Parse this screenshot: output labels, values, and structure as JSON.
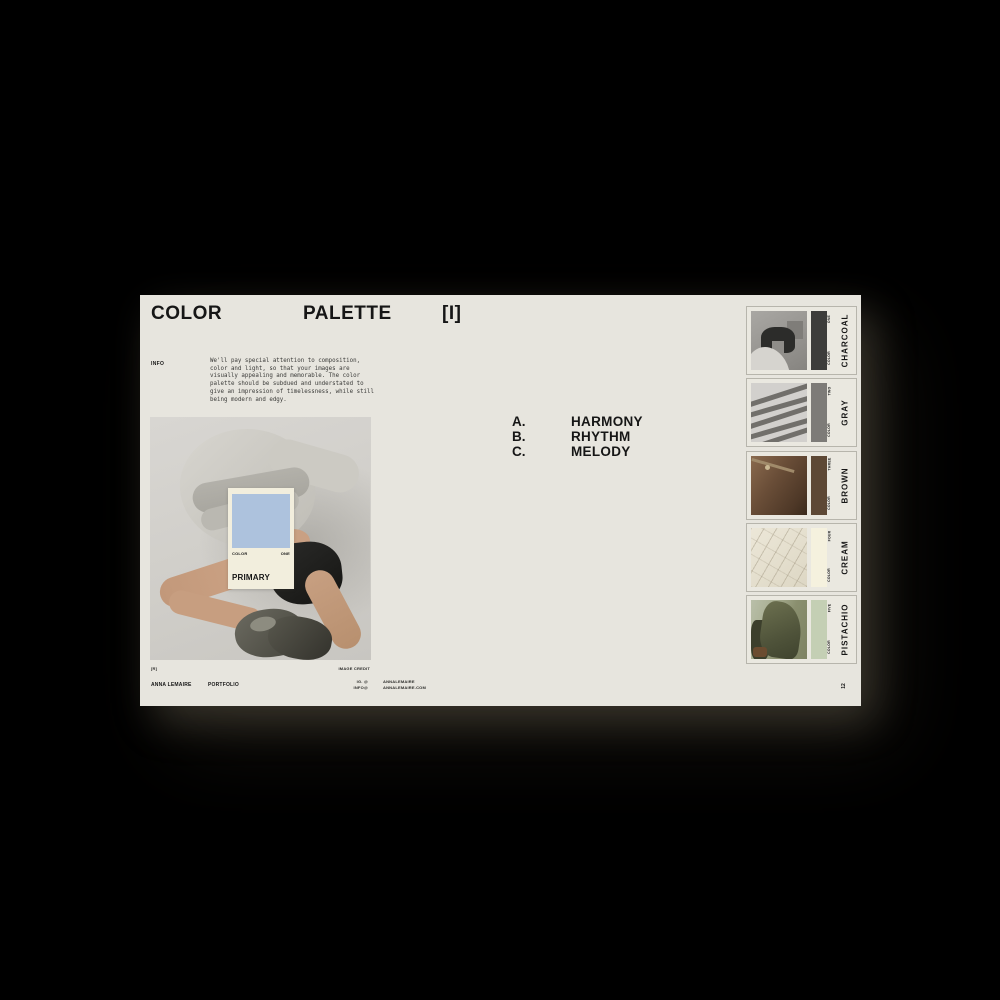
{
  "slide": {
    "header": {
      "word1": "COLOR",
      "word2": "PALETTE",
      "index_label": "[I]"
    },
    "info": {
      "label": "INFO",
      "body": "We'll pay special attention to composition, color and light, so that your images are visually appealing and memorable. The color palette should be subdued and understated to give an impression of timelessness, while still being modern and edgy."
    },
    "principles": [
      {
        "letter": "A.",
        "term": "HARMONY"
      },
      {
        "letter": "B.",
        "term": "RHYTHM"
      },
      {
        "letter": "C.",
        "term": "MELODY"
      }
    ],
    "primary_card": {
      "name": "PRIMARY",
      "series_label": "COLOR",
      "number_label": "ONE",
      "hex": "#adc2dd"
    },
    "photo": {
      "credit_mark": "[R]",
      "credit_label": "IMAGE CREDIT"
    },
    "swatch_cards": [
      {
        "name": "CHARCOAL",
        "series_label": "COLOR",
        "number_label": "ONE",
        "hex": "#3d3d3b"
      },
      {
        "name": "GRAY",
        "series_label": "COLOR",
        "number_label": "TWO",
        "hex": "#7d7b78"
      },
      {
        "name": "BROWN",
        "series_label": "COLOR",
        "number_label": "THREE",
        "hex": "#5d4835"
      },
      {
        "name": "CREAM",
        "series_label": "COLOR",
        "number_label": "FOUR",
        "hex": "#f5f1de"
      },
      {
        "name": "PISTACHIO",
        "series_label": "COLOR",
        "number_label": "FIVE",
        "hex": "#c4cfb4"
      }
    ],
    "footer": {
      "author": "ANNA LEMAIRE",
      "document": "PORTFOLIO",
      "ig_label": "IG. @",
      "info_label": "INFO@",
      "ig_value": "ANNALEMAIRE",
      "info_value": "ANNALEMAIRE.COM",
      "page_number": "12"
    }
  }
}
